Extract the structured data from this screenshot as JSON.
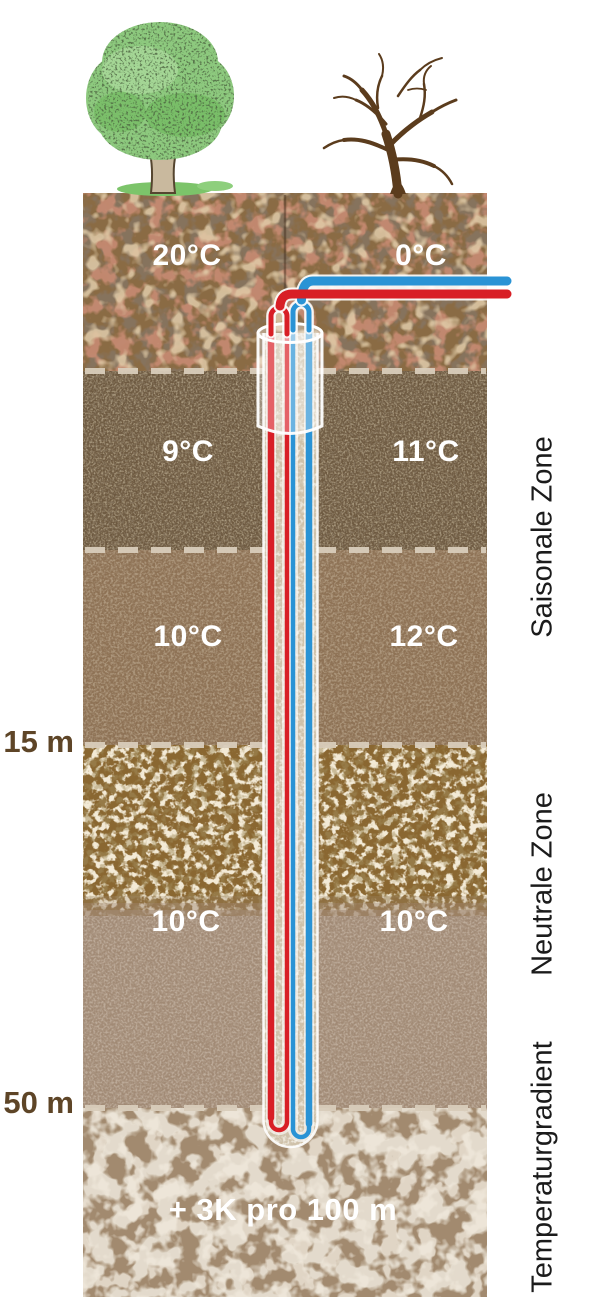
{
  "scene": {
    "surface": {
      "summer_tree_icon": "leafy-summer-tree",
      "winter_tree_icon": "bare-winter-tree"
    },
    "temperatures": {
      "layer1": {
        "left": "20°C",
        "right": "0°C"
      },
      "layer2": {
        "left": "9°C",
        "right": "11°C"
      },
      "layer3": {
        "left": "10°C",
        "right": "12°C"
      },
      "layer4": {
        "left": "10°C",
        "right": "10°C"
      }
    },
    "depth_markers": {
      "m15": "15 m",
      "m50": "50 m"
    },
    "zones": {
      "seasonal": "Saisonale Zone",
      "neutral": "Neutrale Zone",
      "gradient": "Temperaturgradient"
    },
    "gradient_note": "+ 3K pro 100 m",
    "colors": {
      "warm_pipe": "#d81f26",
      "cold_pipe": "#2a93d5",
      "soil_dash": "#d9cdbb"
    }
  }
}
